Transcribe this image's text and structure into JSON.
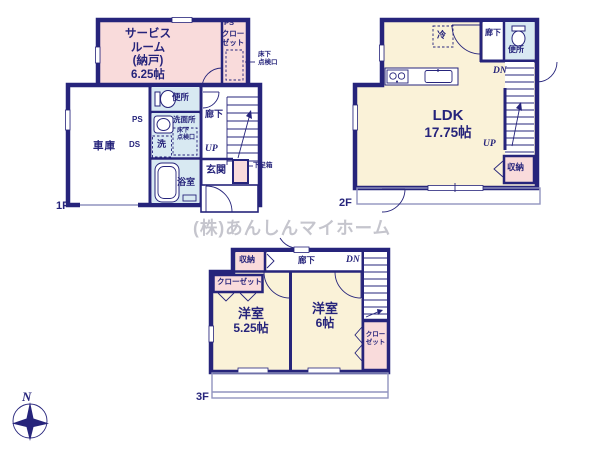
{
  "colors": {
    "wall": "#26247b",
    "text": "#26247b",
    "pink": "#f9dbdb",
    "cream": "#faf2d8",
    "wet": "#d8e9f2",
    "light": "#9193bf",
    "wm": "#c5c5cd"
  },
  "watermark": "(株)あんしんマイホーム",
  "compass": {
    "north": "N"
  },
  "floor1": {
    "label": "1F",
    "service_room": {
      "l1": "サービス",
      "l2": "ルーム",
      "l3": "(納戸)",
      "l4": "6.25帖"
    },
    "ps_top": "PS",
    "closet_l1": "クロー",
    "closet_l2": "ゼット",
    "hatch_l1": "床下",
    "hatch_l2": "点検口",
    "toilet": "便所",
    "washroom": "洗面所",
    "hatch2_l1": "床下",
    "hatch2_l2": "点検口",
    "washer": "洗",
    "ps_left": "PS",
    "ds": "DS",
    "garage": "車庫",
    "bath": "浴室",
    "hall": "廊下",
    "up": "UP",
    "entrance": "玄関",
    "shoe_box": "下足箱"
  },
  "floor2": {
    "label": "2F",
    "fridge": "冷",
    "hall": "廊下",
    "toilet": "便所",
    "dn": "DN",
    "up": "UP",
    "storage": "収納",
    "ldk": {
      "l1": "LDK",
      "l2": "17.75帖"
    }
  },
  "floor3": {
    "label": "3F",
    "storage": "収納",
    "hall": "廊下",
    "dn": "DN",
    "closet_left": "クローゼット",
    "room1": {
      "l1": "洋室",
      "l2": "5.25帖"
    },
    "room2": {
      "l1": "洋室",
      "l2": "6帖"
    },
    "closet_right_l1": "クロー",
    "closet_right_l2": "ゼット"
  }
}
